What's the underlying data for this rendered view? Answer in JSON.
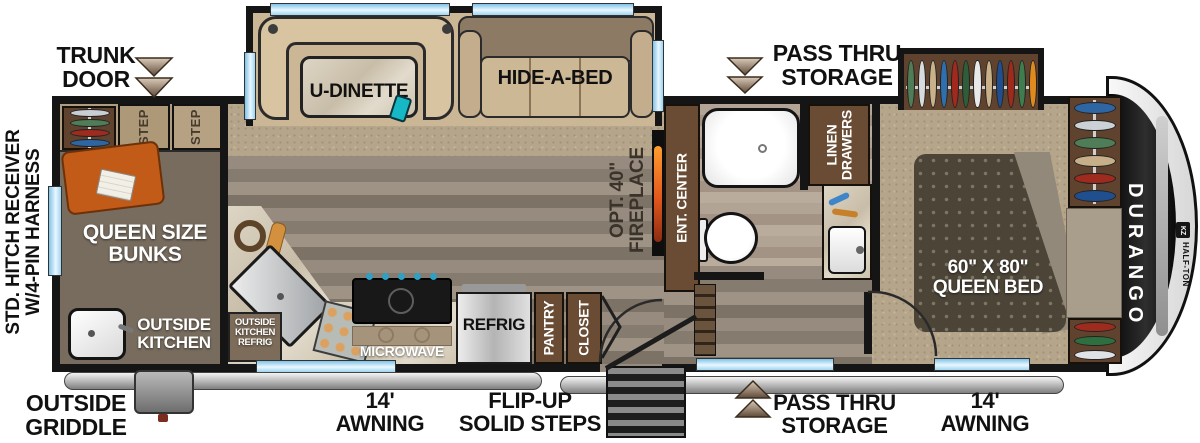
{
  "exterior": {
    "trunk_door": "TRUNK\nDOOR",
    "hitch": "STD. HITCH RECEIVER\nW/4-PIN HARNESS",
    "pass_thru_top": "PASS THRU\nSTORAGE",
    "pass_thru_bottom": "PASS THRU\nSTORAGE",
    "outside_griddle": "OUTSIDE\nGRIDDLE",
    "awning_left": "14'\nAWNING",
    "awning_right": "14'\nAWNING",
    "flip_up_steps": "FLIP-UP\nSOLID STEPS"
  },
  "living": {
    "u_dinette": "U-DINETTE",
    "hide_a_bed": "HIDE-A-BED",
    "fireplace": "OPT. 40\"\nFIREPLACE",
    "ent_center": "ENT. CENTER"
  },
  "bunk_room": {
    "step": "STEP",
    "queen_bunks": "QUEEN SIZE\nBUNKS",
    "outside_kitchen": "OUTSIDE\nKITCHEN"
  },
  "kitchen": {
    "outside_kitchen_refrig": "OUTSIDE\nKITCHEN\nREFRIG",
    "microwave": "MICROWAVE",
    "refrig": "REFRIG",
    "pantry": "PANTRY",
    "closet": "CLOSET"
  },
  "bathroom": {
    "linen_drawers": "LINEN\nDRAWERS"
  },
  "bedroom": {
    "queen_bed": "60\" X 80\"\nQUEEN BED"
  },
  "branding": {
    "model": "DURANGO",
    "trim": "HALF-TON",
    "logo": "KZ"
  },
  "colors": {
    "window_glass": "#a8d7f2",
    "cabinet_brown": "#6a4b33",
    "counter_marble": "#d6cfc0",
    "accent_orange": "#c25a18",
    "flame_orange": "#e2571d",
    "carpet_tan": "#b5a58b",
    "wood_gray": "#8d8276",
    "bed_charcoal": "#4b4437",
    "awning_gray": "#c0c0c0"
  }
}
